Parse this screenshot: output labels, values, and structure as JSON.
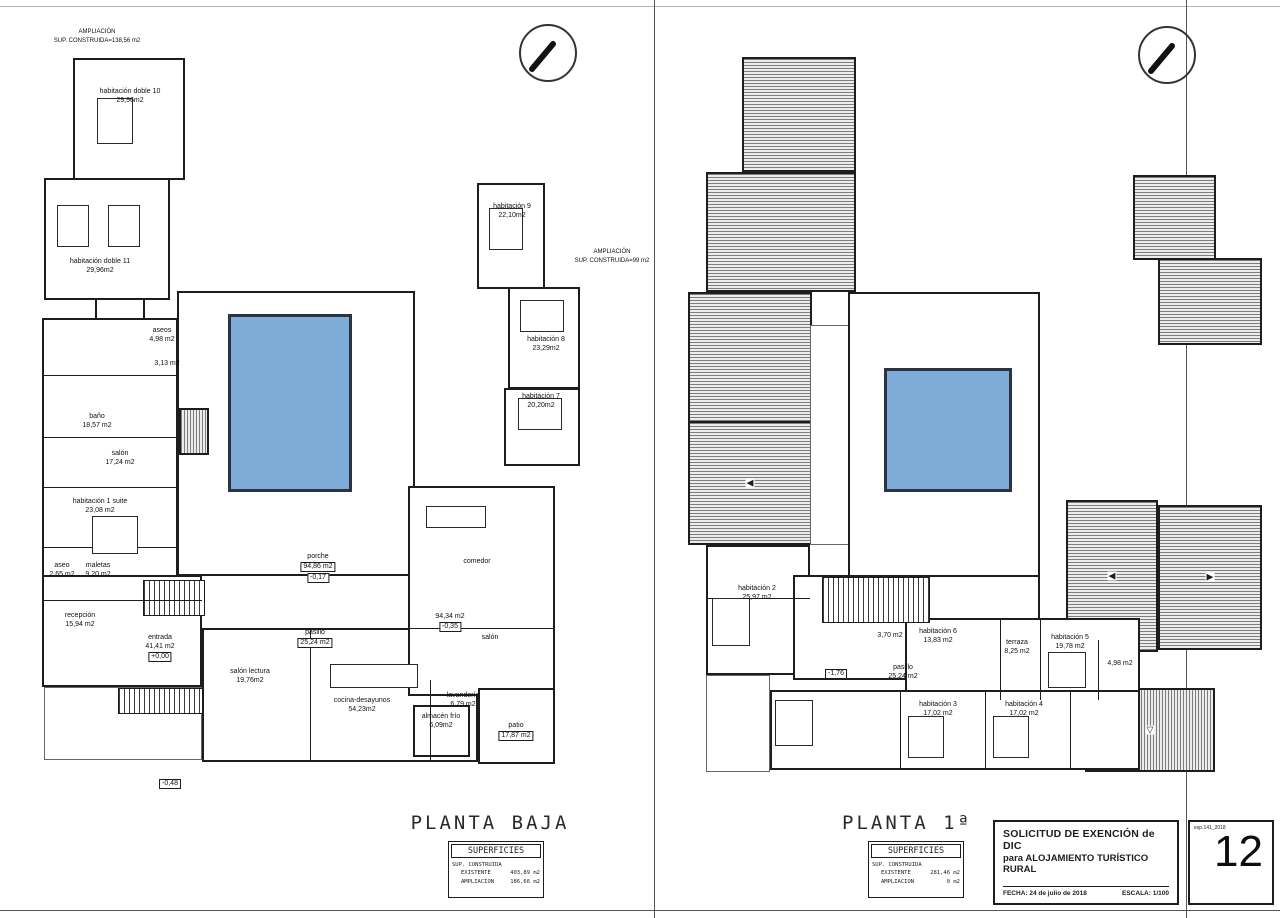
{
  "sheet": {
    "number": "12",
    "ref": "exp.141_2018",
    "colors": {
      "paper": "#ffffff",
      "line": "#1d1d1d",
      "pool": "#7fabd9",
      "roof_hatch": "#7e7e7e"
    },
    "icons": {
      "slope_left": "◀",
      "slope_right": "▶",
      "slope_down": "▽",
      "north_arrow": "north-arrow"
    }
  },
  "title_block": {
    "line1": "SOLICITUD DE EXENCIÓN de DIC",
    "line2": "para ALOJAMIENTO TURÍSTICO RURAL",
    "fecha_label": "FECHA:",
    "fecha_value": "24 de julio de 2018",
    "escala_label": "ESCALA:",
    "escala_value": "1/100"
  },
  "plan_baja": {
    "title": "PLANTA BAJA",
    "superficies": {
      "heading": "SUPERFICIES",
      "group": "SUP. CONSTRUIDA",
      "rows": [
        {
          "label": "EXISTENTE",
          "value": "403,89 m2"
        },
        {
          "label": "AMPLIACION",
          "value": "186,66 m2"
        }
      ]
    },
    "notes": {
      "top": {
        "l1": "AMPLIACIÓN",
        "l2": "SUP. CONSTRUIDA=138,56 m2"
      },
      "right": {
        "l1": "AMPLIACIÓN",
        "l2": "SUP. CONSTRUIDA=99 m2"
      }
    },
    "rooms": [
      {
        "name": "habitación doble 10",
        "area": "29,96m2"
      },
      {
        "name": "habitación doble 11",
        "area": "29,96m2"
      },
      {
        "name": "habitación 9",
        "area": "22,10m2"
      },
      {
        "name": "habitación 8",
        "area": "23,29m2"
      },
      {
        "name": "habitación 7",
        "area": "20,20m2"
      },
      {
        "name": "aseos",
        "area": "4,98 m2"
      },
      {
        "name": "aseo",
        "area": "3,13 m2"
      },
      {
        "name": "baño",
        "area": "18,57 m2"
      },
      {
        "name": "salón",
        "area": "17,24 m2"
      },
      {
        "name": "habitación 1 suite",
        "area": "23,08 m2"
      },
      {
        "name": "aseo",
        "area": "2,65 m2"
      },
      {
        "name": "maletas",
        "area": "9,20 m2"
      },
      {
        "name": "recepción",
        "area": "15,94 m2"
      },
      {
        "name": "entrada",
        "area": "41,41 m2"
      },
      {
        "name": "porche",
        "area": "94,86 m2"
      },
      {
        "name": "pasillo",
        "area": "25,24 m2"
      },
      {
        "name": "salón lectura",
        "area": "19,76m2"
      },
      {
        "name": "cocina-desayunos",
        "area": "54,23m2"
      },
      {
        "name": "almacén frío",
        "area": "6,09m2"
      },
      {
        "name": "lavandería",
        "area": "6,79 m2"
      },
      {
        "name": "patio",
        "area": "17,87 m2"
      },
      {
        "name": "comedor",
        "area": "94,34 m2"
      },
      {
        "name": "salón",
        "area": ""
      }
    ],
    "levels": {
      "porche": "-0,17",
      "comedor": "-0,35",
      "entrada": "+0,00",
      "exterior": "-0,48"
    }
  },
  "plan_primera": {
    "title": "PLANTA 1ª",
    "superficies": {
      "heading": "SUPERFICIES",
      "group": "SUP. CONSTRUIDA",
      "rows": [
        {
          "label": "EXISTENTE",
          "value": "281,46 m2"
        },
        {
          "label": "AMPLIACION",
          "value": "0 m2"
        }
      ]
    },
    "rooms": [
      {
        "name": "habitación 2",
        "area": "25,97 m2"
      },
      {
        "name": "baño",
        "area": "3,70 m2"
      },
      {
        "name": "habitación 6",
        "area": "13,83 m2"
      },
      {
        "name": "terraza",
        "area": "8,25 m2"
      },
      {
        "name": "habitación 5",
        "area": "19,78 m2"
      },
      {
        "name": "baño",
        "area": "4,98 m2"
      },
      {
        "name": "pasillo",
        "area": "25,24 m2"
      },
      {
        "name": "habitación 3",
        "area": "17,02 m2"
      },
      {
        "name": "habitación 4",
        "area": "17,02 m2"
      }
    ],
    "levels": {
      "pasillo": "-1,76"
    }
  }
}
